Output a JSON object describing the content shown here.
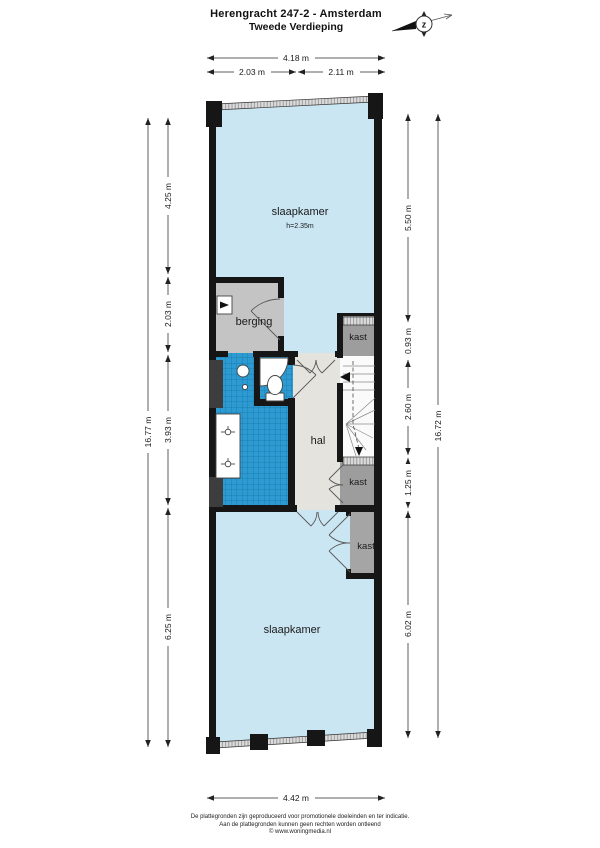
{
  "meta": {
    "title": "Herengracht 247-2 - Amsterdam",
    "subtitle": "Tweede Verdieping",
    "compass_letter": "z"
  },
  "rooms": {
    "slaapkamer_top": {
      "label": "slaapkamer",
      "height_note": "h=2.35m"
    },
    "berging": {
      "label": "berging"
    },
    "kast_top": {
      "label": "kast"
    },
    "hal": {
      "label": "hal"
    },
    "kast_mid": {
      "label": "kast"
    },
    "kast_bottom": {
      "label": "kast"
    },
    "slaapkamer_bottom": {
      "label": "slaapkamer"
    }
  },
  "dimensions": {
    "top_total": "4.18 m",
    "top_left": "2.03 m",
    "top_right": "2.11 m",
    "left_total": "16.77 m",
    "left_seg1": "4.25 m",
    "left_seg2": "2.03 m",
    "left_seg3": "3.93 m",
    "left_seg4": "6.25 m",
    "right_total": "16.72 m",
    "right_seg1": "5.50 m",
    "right_seg2": "0.93 m",
    "right_seg3": "2.60 m",
    "right_seg4": "1.25 m",
    "right_seg5": "6.02 m",
    "bottom_total": "4.42 m"
  },
  "footer": {
    "line1": "De plattegronden zijn geproduceerd voor promotionele doeleinden en ter indicatie.",
    "line2": "Aan de plattegronden kunnen geen rechten worden ontleend",
    "line3": "© www.woningmedia.nl"
  },
  "colors": {
    "room_fill": "#cbe6f3",
    "tile_fill": "#2d9ad1",
    "tile_grid": "#1478aa",
    "gray_room": "#c4c4c4",
    "dark_gray_room": "#9d9d9d",
    "hal_fill": "#e5e3de",
    "stairs_fill": "#fafafa",
    "wall": "#161616"
  }
}
